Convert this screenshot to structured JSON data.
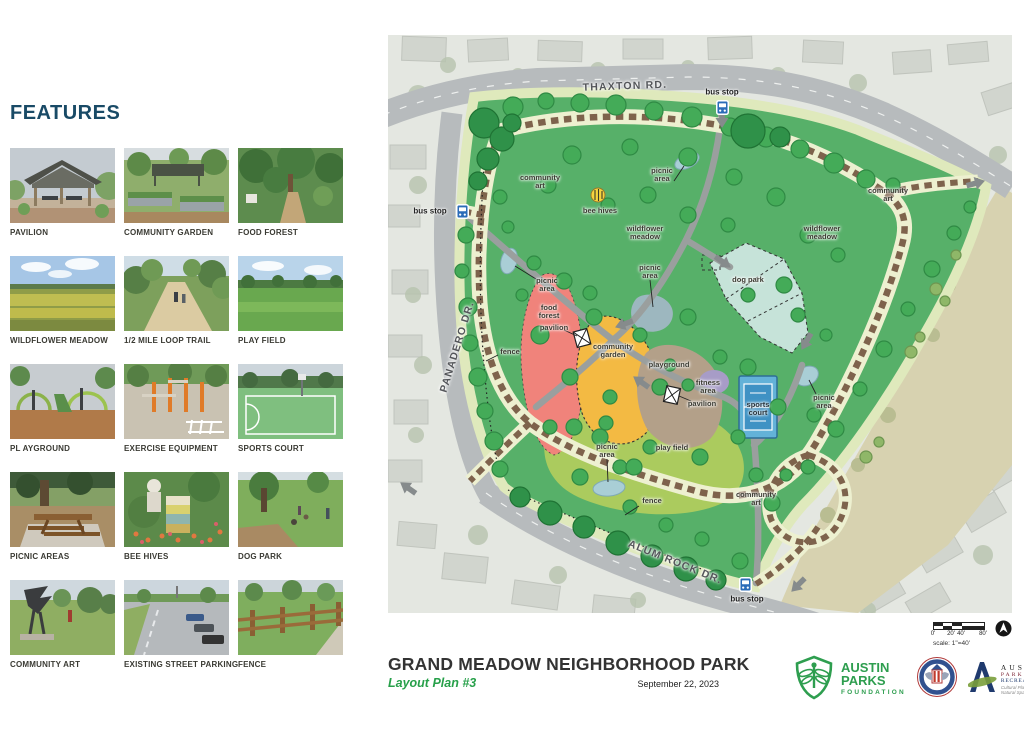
{
  "sidebar": {
    "title": "FEATURES",
    "items": [
      {
        "label": "PAVILION",
        "icon": "pavilion-photo"
      },
      {
        "label": "COMMUNITY GARDEN",
        "icon": "community-garden-photo"
      },
      {
        "label": "FOOD FOREST",
        "icon": "food-forest-photo"
      },
      {
        "label": "WILDFLOWER MEADOW",
        "icon": "wildflower-meadow-photo"
      },
      {
        "label": "1/2 MILE LOOP TRAIL",
        "icon": "loop-trail-photo"
      },
      {
        "label": "PLAY FIELD",
        "icon": "play-field-photo"
      },
      {
        "label": "PL AYGROUND",
        "icon": "playground-photo"
      },
      {
        "label": "EXERCISE EQUIPMENT",
        "icon": "exercise-equipment-photo"
      },
      {
        "label": "SPORTS COURT",
        "icon": "sports-court-photo"
      },
      {
        "label": "PICNIC AREAS",
        "icon": "picnic-areas-photo"
      },
      {
        "label": "BEE HIVES",
        "icon": "bee-hives-photo"
      },
      {
        "label": "DOG PARK",
        "icon": "dog-park-photo"
      },
      {
        "label": "COMMUNITY ART",
        "icon": "community-art-photo"
      },
      {
        "label": "EXISTING STREET PARKING",
        "icon": "street-parking-photo"
      },
      {
        "label": "FENCE",
        "icon": "fence-photo"
      }
    ]
  },
  "map": {
    "street_labels": [
      {
        "t": "THAXTON RD.",
        "x": 237,
        "y": 52,
        "r": -2
      },
      {
        "t": "PANADERO DR.",
        "x": 70,
        "y": 312,
        "r": -73
      },
      {
        "t": "ALUM ROCK DR.",
        "x": 287,
        "y": 528,
        "r": 22
      }
    ],
    "feature_labels": [
      {
        "t": "community\nart",
        "x": 152,
        "y": 147
      },
      {
        "t": "bee hives",
        "x": 212,
        "y": 176
      },
      {
        "t": "picnic\narea",
        "x": 274,
        "y": 140
      },
      {
        "t": "wildflower\nmeadow",
        "x": 257,
        "y": 198
      },
      {
        "t": "wildflower\nmeadow",
        "x": 434,
        "y": 198
      },
      {
        "t": "community\nart",
        "x": 500,
        "y": 160
      },
      {
        "t": "dog park",
        "x": 360,
        "y": 245
      },
      {
        "t": "picnic\narea",
        "x": 262,
        "y": 237
      },
      {
        "t": "picnic\narea",
        "x": 159,
        "y": 250
      },
      {
        "t": "food\nforest",
        "x": 161,
        "y": 277
      },
      {
        "t": "pavilion",
        "x": 166,
        "y": 293
      },
      {
        "t": "community\ngarden",
        "x": 225,
        "y": 316
      },
      {
        "t": "playground",
        "x": 281,
        "y": 330
      },
      {
        "t": "fitness\narea",
        "x": 320,
        "y": 352
      },
      {
        "t": "pavilion",
        "x": 314,
        "y": 369
      },
      {
        "t": "sports\ncourt",
        "x": 370,
        "y": 374,
        "c": "white"
      },
      {
        "t": "picnic\narea",
        "x": 436,
        "y": 367
      },
      {
        "t": "fence",
        "x": 122,
        "y": 317
      },
      {
        "t": "picnic\narea",
        "x": 219,
        "y": 416
      },
      {
        "t": "play field",
        "x": 284,
        "y": 413
      },
      {
        "t": "fence",
        "x": 264,
        "y": 466
      },
      {
        "t": "community\nart",
        "x": 368,
        "y": 464
      }
    ],
    "bus_stops": [
      {
        "label": "bus stop",
        "x": 74,
        "y": 176,
        "lx": 42,
        "ly": 176
      },
      {
        "label": "bus stop",
        "x": 334,
        "y": 72,
        "lx": 334,
        "ly": 57
      },
      {
        "label": "bus stop",
        "x": 357,
        "y": 549,
        "lx": 359,
        "ly": 564
      }
    ],
    "colors": {
      "park_green": "#57b069",
      "edge_band": "#dfe9bc",
      "trail_brown": "#7e634c",
      "trail_base": "#edf0d0",
      "path_gray": "#9a9f9e",
      "food_forest": "#f0837b",
      "community_garden": "#f3ba43",
      "playground": "#b3a089",
      "fitness_area": "#a79cc7",
      "dog_park": "#c6e3d9",
      "sports_court_outer": "#63b2d8",
      "sports_court_inner": "#3f92c4",
      "play_field": "#abcb5e",
      "pond": "#a9ced6",
      "road": "#b7bbbd",
      "field_tan": "#d7d2b0"
    }
  },
  "titleblock": {
    "title": "GRAND MEADOW NEIGHBORHOOD PARK",
    "subtitle": "Layout Plan #3",
    "date": "September 22, 2023"
  },
  "scalebar": {
    "ticks": [
      "0'",
      "20'",
      "40'",
      "80'"
    ],
    "note": "scale: 1\"=40'"
  },
  "logos": {
    "apf": {
      "line1": "AUSTIN",
      "line2": "PARKS",
      "line3": "FOUNDATION"
    },
    "apr": {
      "line1": "AUSTIN",
      "line2": "PARKS &",
      "line3": "RECREATION",
      "tagline": "Cultural Places, Natural Spaces"
    }
  }
}
